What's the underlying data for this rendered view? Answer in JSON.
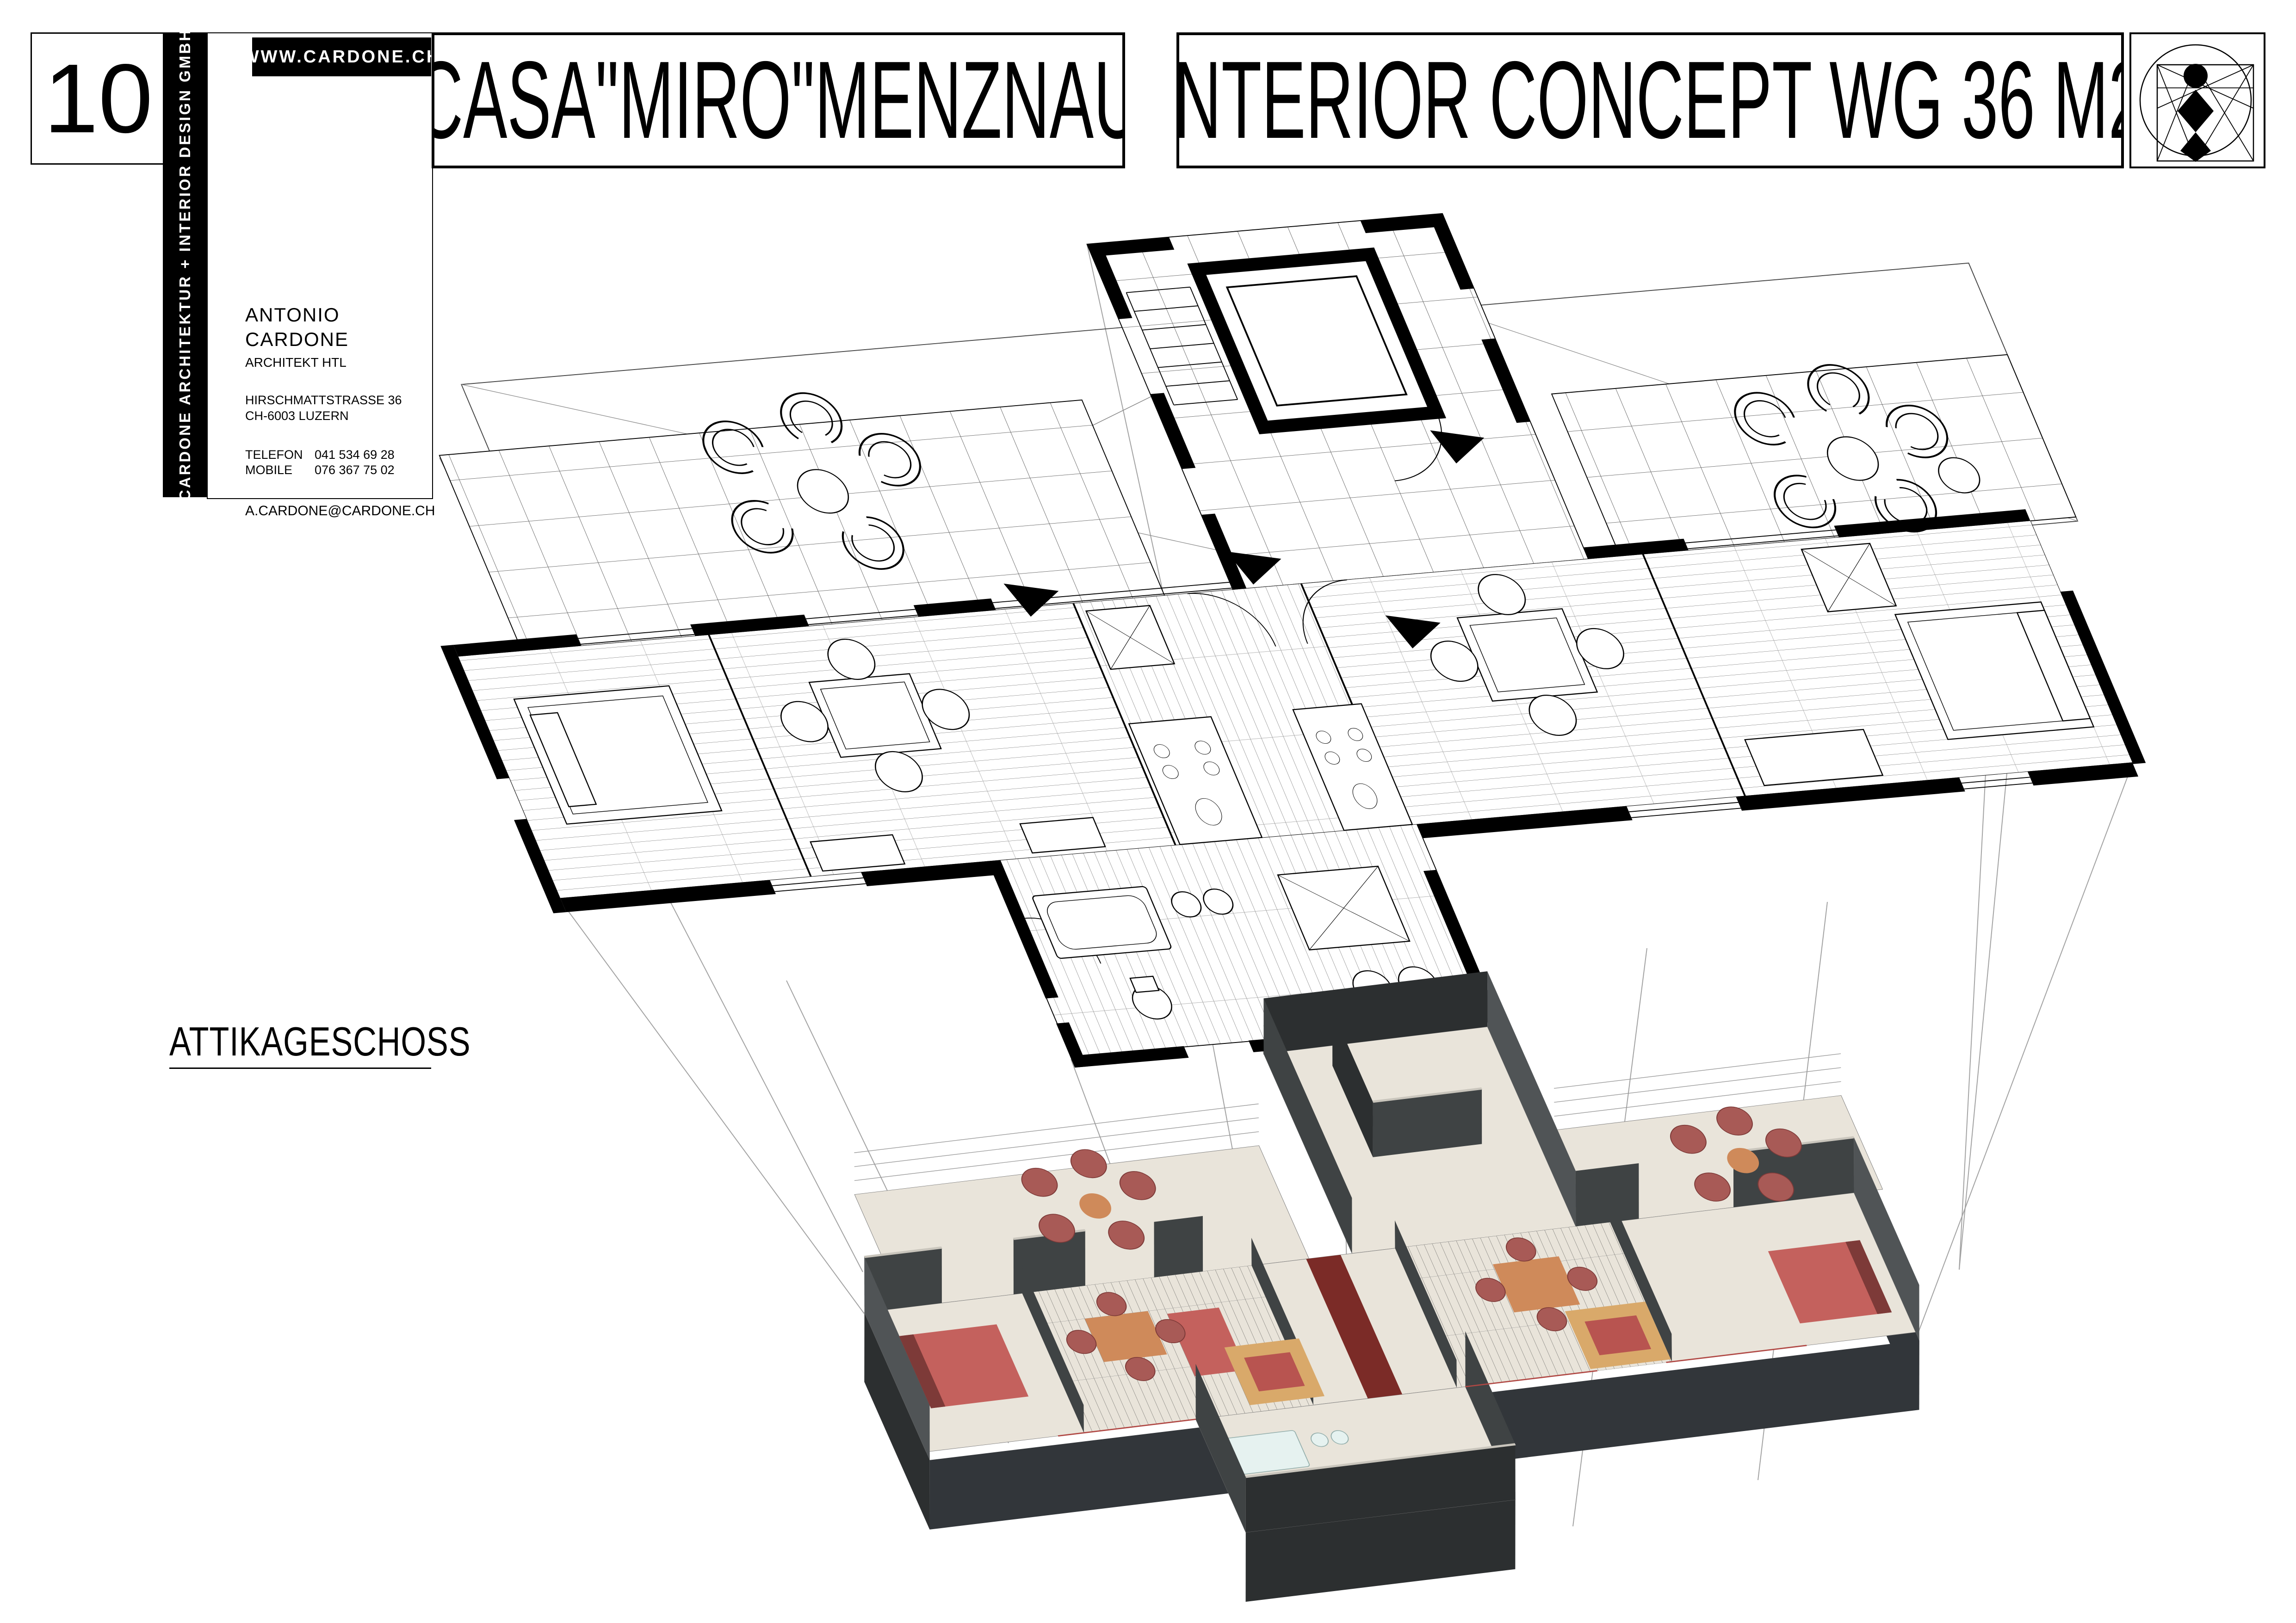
{
  "sheet": {
    "number": "10",
    "floor_label": "ATTIKAGESCHOSS"
  },
  "brand": {
    "company": "CARDONE ARCHITEKTUR + INTERIOR DESIGN GMBH",
    "website": "WWW.CARDONE.CH"
  },
  "architect": {
    "name": "ANTONIO  CARDONE",
    "title": "ARCHITEKT HTL",
    "street": "HIRSCHMATTSTRASSE 36",
    "city": "CH-6003 LUZERN",
    "telefon_label": "TELEFON",
    "telefon": "041 534 69 28",
    "mobile_label": "MOBILE",
    "mobile": "076 367 75 02",
    "email": "A.CARDONE@CARDONE.CH"
  },
  "titles": {
    "project": "CASA\"MIRO\"MENZNAU",
    "concept": "INTERIOR CONCEPT WG 36 M2"
  },
  "logo": {
    "icon": "vitruvian-figure-logo"
  },
  "drawing": {
    "plan": "2d-attic-floor-plan-axonometric",
    "model": "3d-interior-concept-model",
    "projection": "projection-guide-lines"
  },
  "palette": {
    "line_black": "#000000",
    "wall_dark": "#3f4344",
    "wall_darker": "#2c2f30",
    "floor_cream": "#e9e4da",
    "cap_gray": "#c9c5bc",
    "furniture_red": "#c4615d",
    "chair_red": "#a85a56",
    "table_orange": "#cf8a5a",
    "table_tan": "#d9a96a",
    "accent_maroon": "#7b2b27",
    "fixture_white": "#e6f2f0"
  }
}
